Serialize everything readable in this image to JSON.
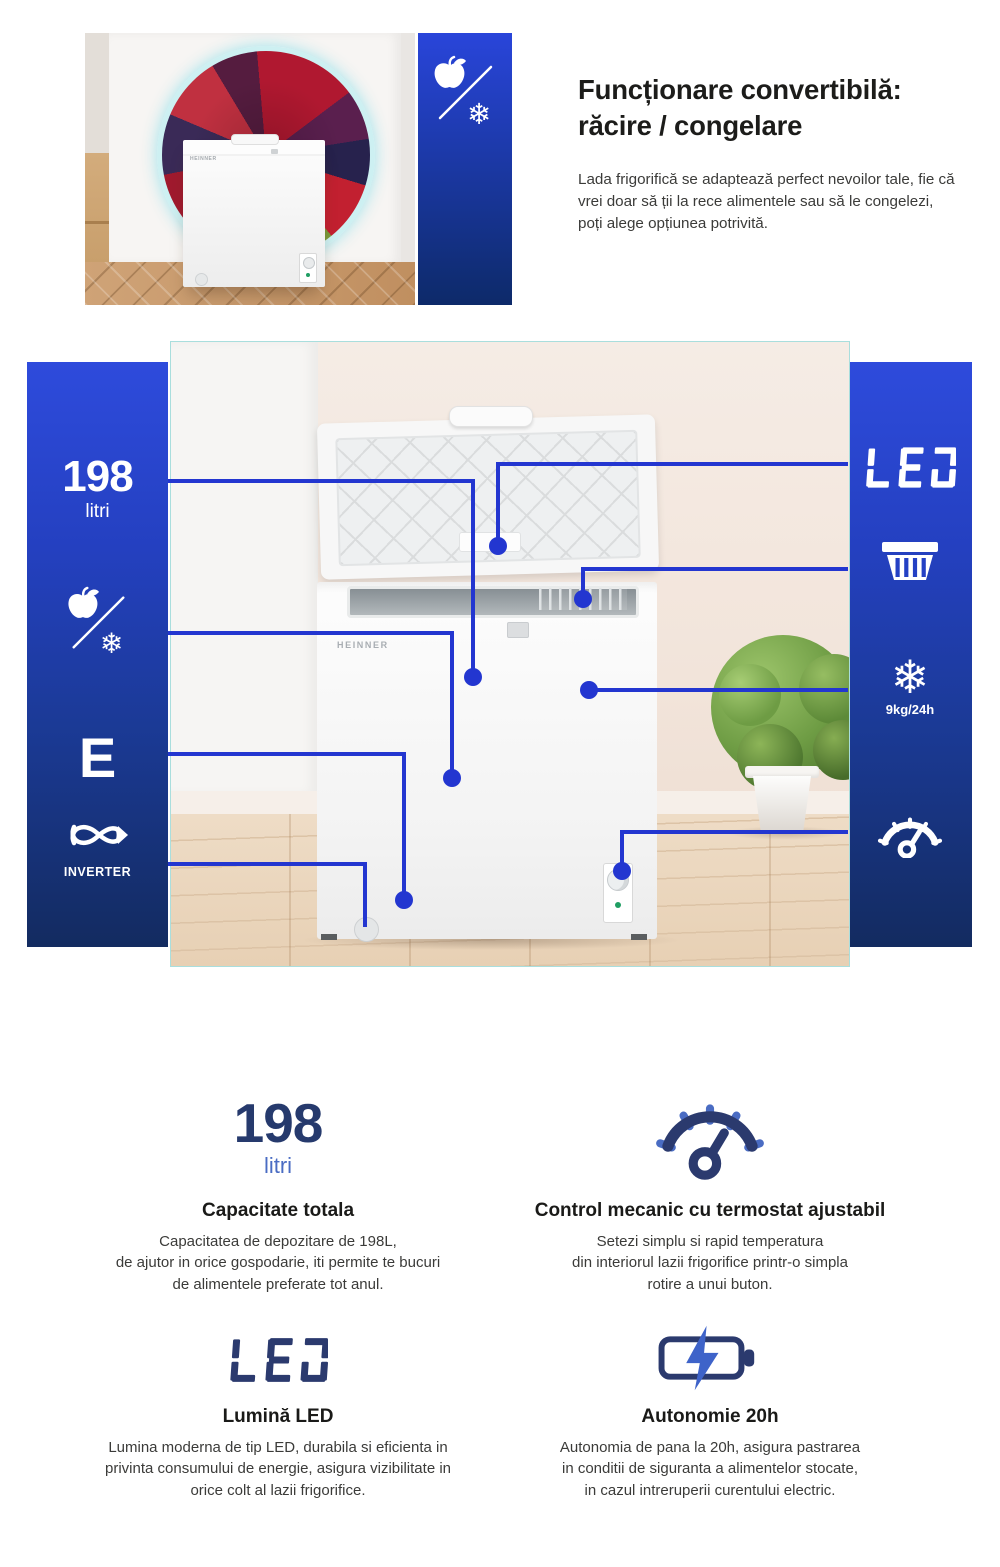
{
  "colors": {
    "accent_line": "#2336d0",
    "bar_top": "#2e4bdc",
    "bar_bottom": "#132b60",
    "navy": "#2b3a6e",
    "blue": "#4a6cc3"
  },
  "hero": {
    "title": "Funcționare convertibilă:\nrăcire / congelare",
    "body": "Lada frigorifică se adaptează perfect nevoilor tale, fie că vrei doar să ții la rece alimentele sau să le congelezi, poți alege opțiunea potrivită.",
    "brand": "HEINNER"
  },
  "diagram": {
    "brand": "HEINNER",
    "left": [
      {
        "value": "198",
        "label": "litri"
      },
      {
        "icon": "apple-snowflake"
      },
      {
        "value": "E"
      },
      {
        "icon": "inverter",
        "label": "INVERTER"
      }
    ],
    "right": [
      {
        "value": "LED"
      },
      {
        "icon": "basket"
      },
      {
        "icon": "snowflake",
        "glyph": "❄",
        "label": "9kg/24h"
      },
      {
        "icon": "thermostat"
      }
    ]
  },
  "features": [
    {
      "stat": "198",
      "stat_label": "litri",
      "title": "Capacitate totala",
      "body": "Capacitatea de depozitare de 198L,\nde ajutor in orice gospodarie, iti permite te bucuri\nde alimentele preferate tot anul."
    },
    {
      "icon": "thermostat",
      "title": "Control mecanic cu termostat ajustabil",
      "body": "Setezi simplu si rapid temperatura\ndin interiorul lazii frigorifice printr-o simpla\nrotire a unui buton."
    },
    {
      "stat": "LED",
      "icon": "led-digital",
      "title": "Lumină LED",
      "body": "Lumina moderna de tip LED, durabila si eficienta in\nprivinta consumului de energie, asigura vizibilitate in\norice colt al lazii frigorifice."
    },
    {
      "icon": "battery",
      "title": "Autonomie 20h",
      "body": "Autonomia de pana la 20h, asigura pastrarea\nin conditii de siguranta a alimentelor stocate,\nin cazul intreruperii curentului electric."
    }
  ]
}
